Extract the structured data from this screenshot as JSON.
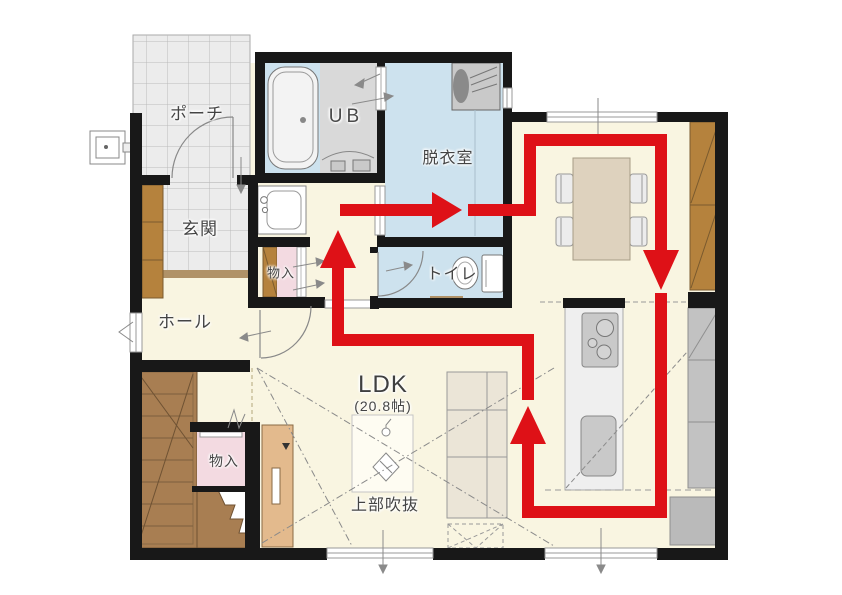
{
  "plan": {
    "floor_area_label": "LDK",
    "floor_area_size": "(20.8帖)"
  },
  "rooms": {
    "porch": {
      "label": "ポーチ"
    },
    "entrance": {
      "label": "玄関"
    },
    "unit_bath": {
      "label": "UB"
    },
    "dressing": {
      "label": "脱衣室"
    },
    "toilet": {
      "label": "トイレ"
    },
    "storage_upper": {
      "label": "物入"
    },
    "hall": {
      "label": "ホール"
    },
    "storage_lower": {
      "label": "物入"
    },
    "ldk": {
      "label": "LDK",
      "size": "(20.8帖)"
    },
    "void": {
      "label": "上部吹抜"
    }
  },
  "route": {
    "name": "circulation-flow-loop",
    "color": "#de1117",
    "segments": [
      [
        [
          340,
          210
        ],
        [
          436,
          210
        ]
      ],
      [
        [
          468,
          210
        ],
        [
          530,
          210
        ],
        [
          530,
          140
        ],
        [
          661,
          140
        ],
        [
          661,
          250
        ]
      ],
      [
        [
          661,
          293
        ],
        [
          661,
          512
        ],
        [
          528,
          512
        ],
        [
          528,
          444
        ]
      ],
      [
        [
          528,
          400
        ],
        [
          528,
          340
        ],
        [
          338,
          340
        ],
        [
          338,
          268
        ]
      ]
    ],
    "arrowheads": [
      [
        [
          432,
          192
        ],
        [
          462,
          210
        ],
        [
          432,
          228
        ]
      ],
      [
        [
          643,
          250
        ],
        [
          679,
          250
        ],
        [
          661,
          290
        ]
      ],
      [
        [
          510,
          444
        ],
        [
          546,
          444
        ],
        [
          528,
          406
        ]
      ],
      [
        [
          320,
          268
        ],
        [
          356,
          268
        ],
        [
          338,
          230
        ]
      ]
    ]
  },
  "fixtures": [
    "bathtub",
    "washing-machine",
    "washbasin",
    "toilet-bowl",
    "dining-table",
    "dining-chairs",
    "kitchen-island",
    "stove",
    "sink",
    "sofa",
    "stairs",
    "tv-board",
    "refrigerator",
    "wall-cabinet",
    "counter",
    "outdoor-faucet",
    "pendant-light"
  ],
  "colors": {
    "floor_cream": "#f9f5e1",
    "wet_room_blue": "#cde2ee",
    "tile_gray": "#ececec",
    "storage_pink": "#f3dae1",
    "cabinet_brown": "#b5823d",
    "stair_brown": "#a87e52",
    "wall_black": "#181818",
    "route_red": "#de1117"
  }
}
